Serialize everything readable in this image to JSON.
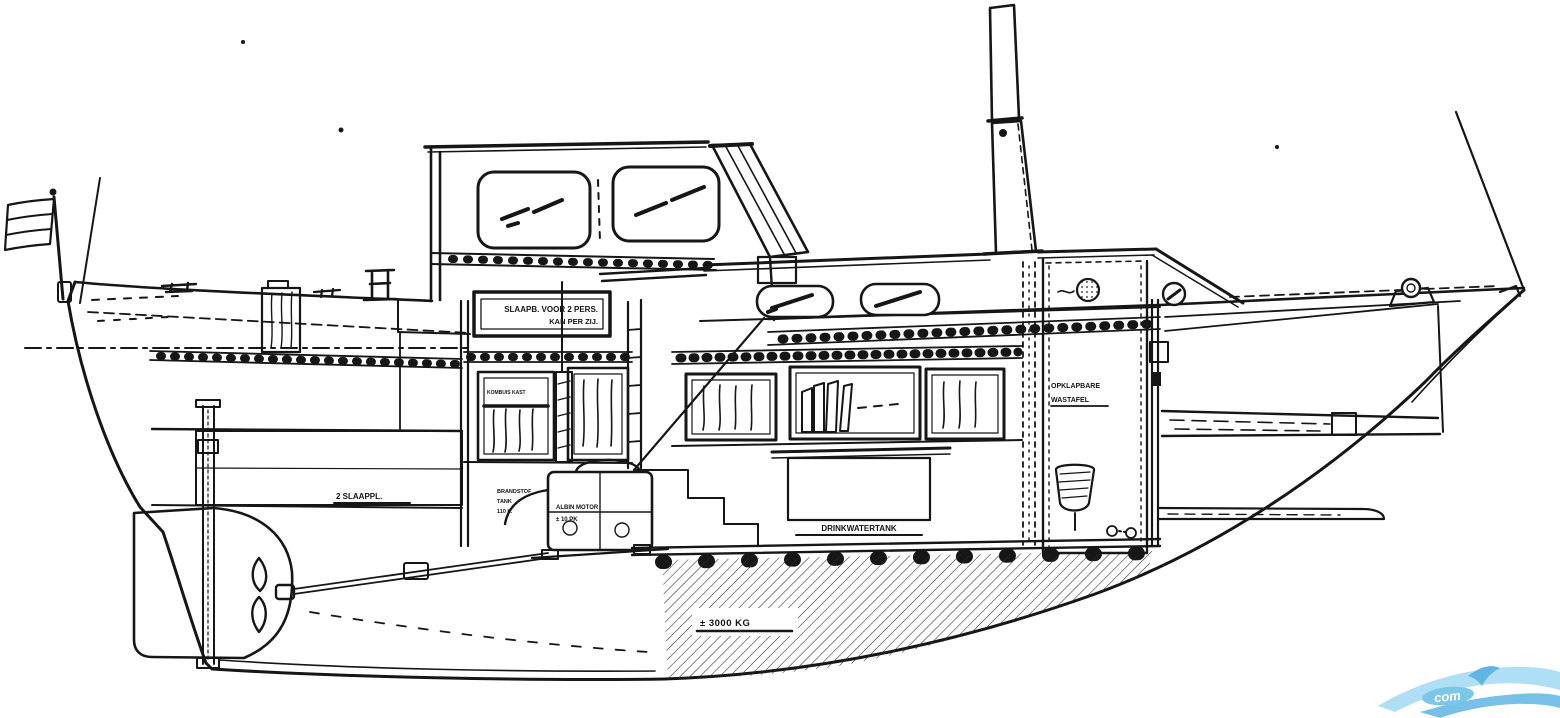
{
  "labels": {
    "plate_line1": "SLAAPB. VOOR 2 PERS.",
    "plate_line2": "KAN PER ZIJ.",
    "galley_shelf": "KOMBUIS KAST",
    "aft_cabin": "2 SLAAPPL.",
    "engine_left_1": "BRANDSTOF",
    "engine_left_2": "TANK",
    "engine_left_3": "110 L.",
    "engine_right_1": "ALBIN MOTOR",
    "engine_right_2": "± 10 PK",
    "water_tank": "DRINKWATERTANK",
    "ballast": "± 3000 KG",
    "washbasin_1": "OPKLAPBARE",
    "washbasin_2": "WASTAFEL"
  },
  "watermark": {
    "text": "com",
    "color_light": "#a6dcf4",
    "color_mid": "#5fb6e4"
  },
  "colors": {
    "ink": "#161616",
    "paper": "#ffffff"
  }
}
